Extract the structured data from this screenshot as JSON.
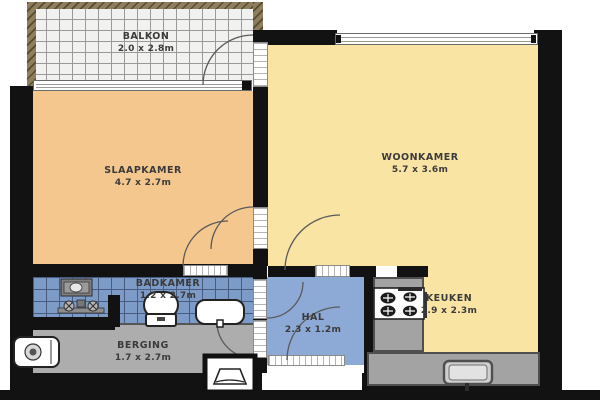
{
  "plan": {
    "title": "apartment floor plan",
    "rooms": [
      {
        "name": "BALKON",
        "dims": "2.0 x 2.8m"
      },
      {
        "name": "SLAAPKAMER",
        "dims": "4.7 x 2.7m"
      },
      {
        "name": "WOONKAMER",
        "dims": "5.7 x 3.6m"
      },
      {
        "name": "BADKAMER",
        "dims": "1.2 x 2.7m"
      },
      {
        "name": "HAL",
        "dims": "2.3 x 1.2m"
      },
      {
        "name": "BERGING",
        "dims": "1.7 x 2.7m"
      },
      {
        "name": "KEUKEN",
        "dims": "2.9 x 2.3m"
      }
    ],
    "fixtures": [
      "washing-machine-icon",
      "shower-mixer-icon",
      "toilet-icon",
      "bathroom-sink-icon",
      "boiler-icon",
      "ventilation-box-icon",
      "cooktop-icon",
      "kitchen-sink-icon"
    ],
    "colors": {
      "wall": "#121212",
      "slaapkamer": "#f4c78e",
      "woonkamer_keuken": "#f9e4a4",
      "badkamer_tile": "#7d9bc7",
      "hal": "#8caad5",
      "berging": "#adadad",
      "balkon": "#f1f1ef",
      "counter": "#a3a3a3",
      "railing": "#8e7e5e"
    }
  }
}
